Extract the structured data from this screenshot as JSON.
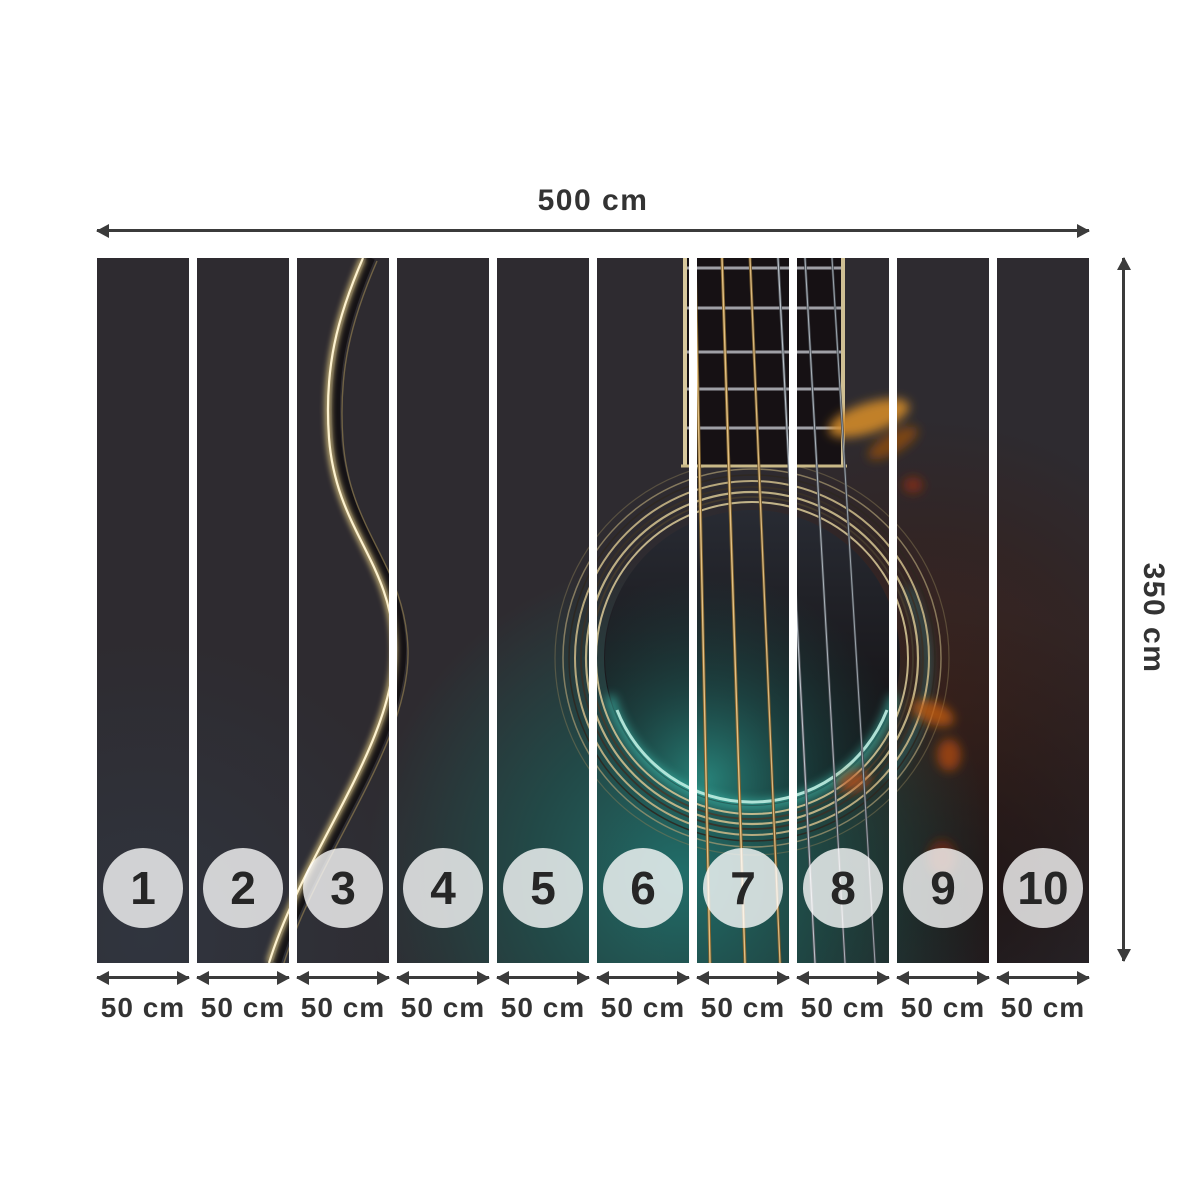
{
  "mural": {
    "description": "acoustic guitar close-up photo: fretboard, six strings, sound hole with rosette rings, teal soundboard glow, gold body-edge curve",
    "total_width_label": "500 cm",
    "total_height_label": "350 cm",
    "panel_count": 10,
    "panels": [
      {
        "number": "1",
        "width_label": "50 cm"
      },
      {
        "number": "2",
        "width_label": "50 cm"
      },
      {
        "number": "3",
        "width_label": "50 cm"
      },
      {
        "number": "4",
        "width_label": "50 cm"
      },
      {
        "number": "5",
        "width_label": "50 cm"
      },
      {
        "number": "6",
        "width_label": "50 cm"
      },
      {
        "number": "7",
        "width_label": "50 cm"
      },
      {
        "number": "8",
        "width_label": "50 cm"
      },
      {
        "number": "9",
        "width_label": "50 cm"
      },
      {
        "number": "10",
        "width_label": "50 cm"
      }
    ]
  },
  "icons": {
    "width_arrow": "double-headed-horizontal-arrow",
    "height_arrow": "double-headed-vertical-arrow",
    "panel_width_arrow": "double-headed-horizontal-arrow"
  },
  "colors": {
    "page_background": "#ffffff",
    "dimension_lines": "#3b3b3b",
    "dimension_text": "#333333",
    "panel_base": "#2e2b30",
    "panel_gap": "#ffffff",
    "circle_fill": "rgba(255,255,255,0.78)",
    "circle_text": "#262626",
    "accent_teal": "#2e968c",
    "accent_gold": "#d9c48e",
    "accent_amber": "#c05a14"
  }
}
